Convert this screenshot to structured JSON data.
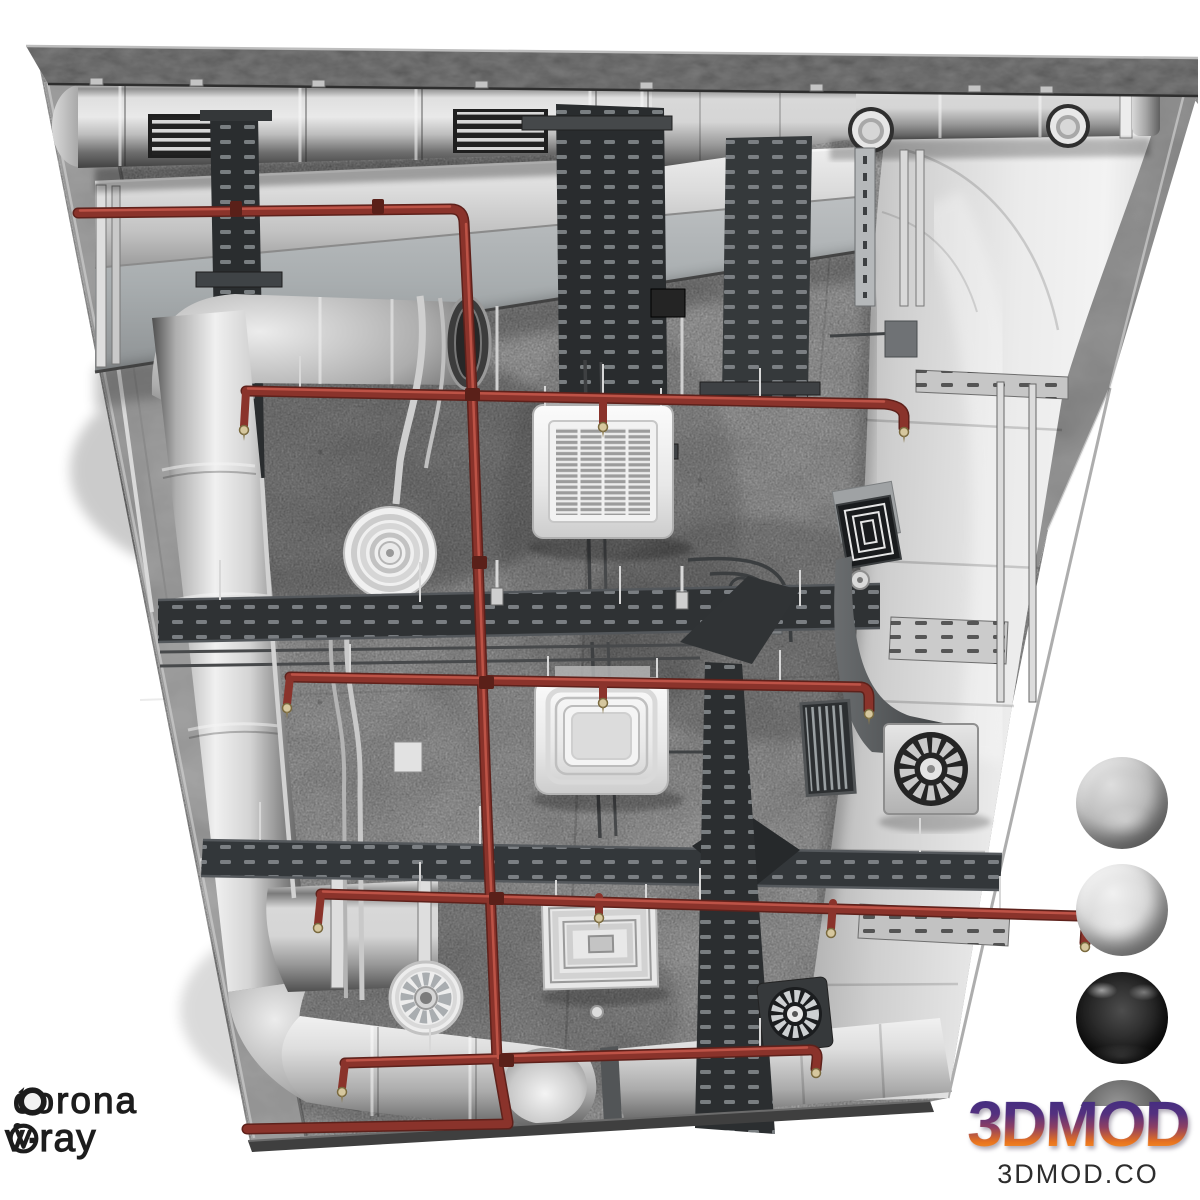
{
  "page": {
    "background": "#ffffff",
    "width": 1200,
    "height": 1200
  },
  "render": {
    "subject": "Ceiling HVAC and ventilation system 3D model, viewed from below",
    "palette": {
      "concrete": "#9a9a9a",
      "slab_edge": "#6e6e6e",
      "duct_metal_light": "#d9d9d9",
      "duct_metal_dark": "#474747",
      "pipe_red": "#8a332b",
      "pipe_red_highlight": "#c2574a",
      "cable_tray_dark": "#2f3234",
      "cable_tray_light": "#c9c9c9",
      "cassette_white": "#efefef",
      "sprinkler_brass": "#d6c79e"
    },
    "equipment": [
      "spiral round duct with louvered grilles",
      "duct cone transition with round take-off collars and end cap",
      "rectangular duct run",
      "large curved rectangular duct on right side",
      "left vertical spiral duct with elbows and branch flange",
      "bottom horizontal spiral duct run with down elbow",
      "ceiling cassette AC unit with slatted grille",
      "four-way round-flow ceiling cassette",
      "white square supply diffuser",
      "dark square diffuser with plenum box",
      "round ceiling diffuser",
      "axial duct fan",
      "panel fan unit with radial blades",
      "small inline fan",
      "dark louvered equipment box",
      "perforated cable trays and ladder trays",
      "electrical conduits",
      "red fire sprinkler piping with sprinkler heads",
      "concrete slab ceiling with edge band"
    ]
  },
  "materials_panel": {
    "spheres": [
      {
        "name": "concrete-rough",
        "appearance": "matte light gray textured"
      },
      {
        "name": "galvanized-steel",
        "appearance": "bright mottled metal"
      },
      {
        "name": "black-glossy",
        "appearance": "dark reflective plastic"
      },
      {
        "name": "dark-metal-partial",
        "appearance": "top sliver visible behind logo"
      }
    ]
  },
  "branding": {
    "corona": {
      "label": "corona",
      "icon": "corona-renderer-icon",
      "color": "#1d1d1d"
    },
    "vray": {
      "label": "v·ray",
      "icon": "vray-icon",
      "color": "#1d1d1d"
    },
    "studio": {
      "name": "3DMOD",
      "website": "3DMOD.CO",
      "gradient_top": "#3f2d80",
      "gradient_bottom": "#f9992a",
      "website_color": "#2d2d2d"
    }
  }
}
